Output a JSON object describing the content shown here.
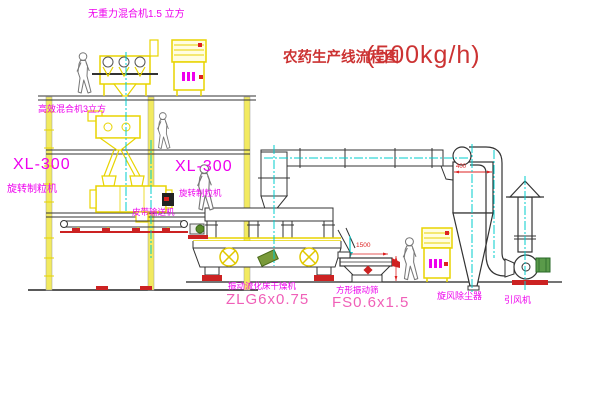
{
  "title": {
    "name": "农药生产线流程图",
    "capacity": "(500kg/h)"
  },
  "labels": {
    "gravity_mixer": "无重力混合机1.5 立方",
    "high_eff_mixer": "高效混合机3立方",
    "granulator_model_left": "XL-300",
    "granulator_name_left": "旋转制粒机",
    "granulator_model_mid": "XL-300",
    "granulator_name_mid": "旋转制粒机",
    "belt_conveyor": "皮带输送机",
    "dryer_name": "振动流化床干燥机",
    "dryer_model": "ZLG6x0.75",
    "sieve_name": "方形振动筛",
    "sieve_model": "FS0.6x1.5",
    "cyclone_name": "旋风除尘器",
    "fan_name": "引风机"
  },
  "dimensions": {
    "sieve_length": "1500",
    "cyclone_dia": "400"
  },
  "colors": {
    "annotation_magenta": "#ee00ee",
    "model_pink": "#f060b8",
    "title_red": "#cc3333",
    "machine_yellow": "#e8d400",
    "centerline_cyan": "#00cccc",
    "base_red": "#cc2222"
  }
}
